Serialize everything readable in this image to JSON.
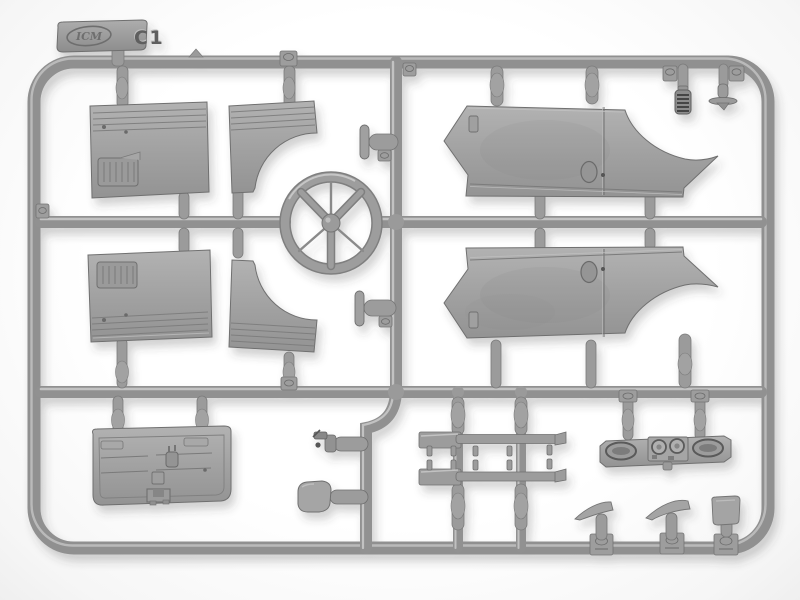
{
  "meta": {
    "type": "photograph",
    "subject": "Grey injection-moulded plastic model-kit sprue (parts frame) photographed on a white background",
    "background_color": "#ffffff"
  },
  "sprue": {
    "brand": "ICM",
    "frame_label": "C1",
    "plastic": {
      "base_color": "#9b9b9b",
      "highlight_color": "#c4c4c4",
      "edge_color": "#6f6f6f",
      "recess_color": "#7a7a7a",
      "shadow_opacity": 0.24
    },
    "parts": [
      {
        "id": "brand-tab",
        "label": "moulding tab with ICM logo and frame code C1"
      },
      {
        "id": "door-panel-upper",
        "label": "cab door panel with pull pocket"
      },
      {
        "id": "door-panel-lower",
        "label": "cab door panel, mirrored"
      },
      {
        "id": "arch-panel-upper",
        "label": "side panel with wheel-arch cut-out"
      },
      {
        "id": "arch-panel-lower",
        "label": "side panel with wheel-arch cut-out, mirrored"
      },
      {
        "id": "steering-wheel",
        "label": "three-spoke steering wheel"
      },
      {
        "id": "body-side-panel-upper",
        "label": "long body side panel with rear wheel arch and door line"
      },
      {
        "id": "body-side-panel-lower",
        "label": "long body side panel, mirrored"
      },
      {
        "id": "tailgate-panel",
        "label": "tailgate panel with hinges and latch"
      },
      {
        "id": "lever-part-upper",
        "label": "small lever / handle"
      },
      {
        "id": "lever-part-lower",
        "label": "small lever / handle"
      },
      {
        "id": "fitting-small-part",
        "label": "small detailed fitting"
      },
      {
        "id": "mirror-part",
        "label": "rear-view mirror with arm"
      },
      {
        "id": "rod-part-upper",
        "label": "linkage rod with mounting pegs"
      },
      {
        "id": "rod-part-lower",
        "label": "linkage rod with mounting pegs"
      },
      {
        "id": "dashboard",
        "label": "dashboard with twin oval dials and gauges"
      },
      {
        "id": "ribbed-cap-part",
        "label": "small ribbed cylindrical part"
      },
      {
        "id": "disc-base-part",
        "label": "small disc-base part"
      },
      {
        "id": "wing-part-1",
        "label": "small wing-shaped bracket"
      },
      {
        "id": "wing-part-2",
        "label": "small wing-shaped bracket"
      },
      {
        "id": "plate-part",
        "label": "small rectangular plate"
      }
    ]
  }
}
